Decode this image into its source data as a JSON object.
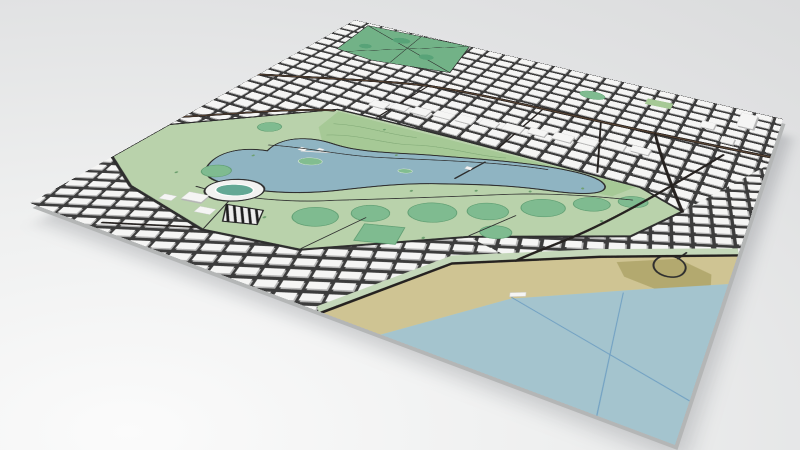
{
  "scene": {
    "kind": "3d-map-render",
    "features": [
      "city-grid-north",
      "city-grid-south",
      "city-grid-east",
      "fawkner-park",
      "albert-park",
      "golf-course",
      "lake",
      "lake-island",
      "athletics-stadium",
      "hatched-lot",
      "sports-ovals",
      "beach",
      "ocean",
      "esplanade-road",
      "main-road-north",
      "highway-west",
      "water-boundary-lines",
      "high-rise-tower"
    ]
  },
  "colors": {
    "bg_light": "#fbfbfb",
    "bg_mid": "#eeefef",
    "bg_dark": "#e1e2e3",
    "bg_darker": "#dbdcdd",
    "slab_side": "#b4b6b6",
    "shadow": "rgba(70,75,80,0.22)",
    "base_green": "#c5d8ba",
    "park_green": "#b9d2ab",
    "golf_green": "#a6c996",
    "fawkner_green": "#72b287",
    "field_green": "#7fbb90",
    "field_dark": "#58a378",
    "field_stroke": "#5d9c70",
    "lake_blue": "#8fb4c2",
    "ocean_blue": "#a4c4ce",
    "sand": "#cfc493",
    "sand_dark": "#b3a96f",
    "water_line": "#6f9fc2",
    "street_dark": "#3c3c3c",
    "road_dark": "#262220",
    "road_brown": "#5c4634",
    "path_dark": "#2e2e2e",
    "block_white": "#f5f5f4",
    "block_shade": "#b5b5b5",
    "stadium_white": "#f2f2f1",
    "stadium_infield": "#63a895",
    "island_green": "#82bd90",
    "contour_green": "#83ab78",
    "tree_green": "#6ea06f"
  }
}
